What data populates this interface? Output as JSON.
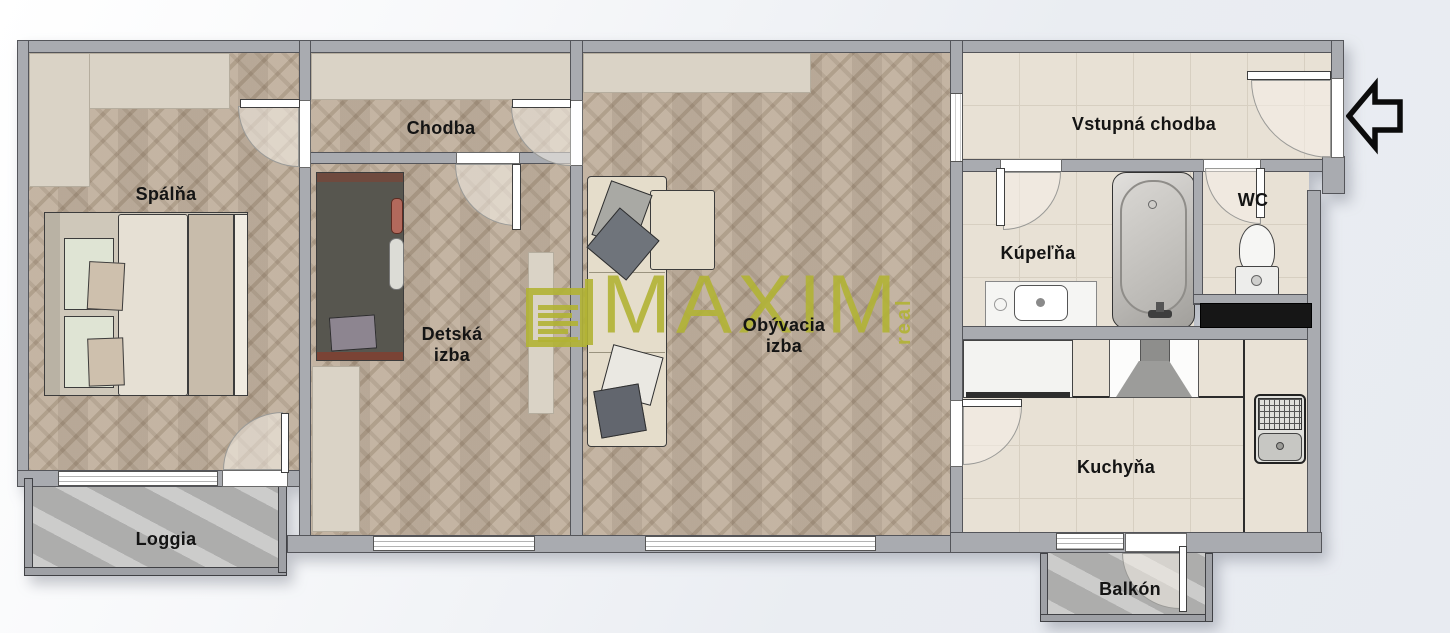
{
  "watermark": {
    "brand": "MAXIM",
    "tagline": "real",
    "color": "#b1b234",
    "logo": "document-lines-icon"
  },
  "entrance_arrow": {
    "direction": "left"
  },
  "rooms": [
    {
      "id": "spalna",
      "label": "Spálňa"
    },
    {
      "id": "chodba",
      "label": "Chodba"
    },
    {
      "id": "detska-izba",
      "label": "Detská\nizba"
    },
    {
      "id": "obyvacia-izba",
      "label": "Obývacia\nizba"
    },
    {
      "id": "vstupna-chodba",
      "label": "Vstupná chodba"
    },
    {
      "id": "kupelna",
      "label": "Kúpeľňa"
    },
    {
      "id": "wc",
      "label": "WC"
    },
    {
      "id": "kuchyna",
      "label": "Kuchyňa"
    },
    {
      "id": "loggia",
      "label": "Loggia"
    },
    {
      "id": "balkon",
      "label": "Balkón"
    }
  ],
  "colors": {
    "wall": "#a9abb0",
    "parquet": "#bcab97",
    "tile": "#e8e1d5",
    "stone": "#b6b6b5",
    "watermark": "#b1b234",
    "outline": "#3c3c3c",
    "background": "#eaedf2",
    "counter_black": "#161616"
  }
}
